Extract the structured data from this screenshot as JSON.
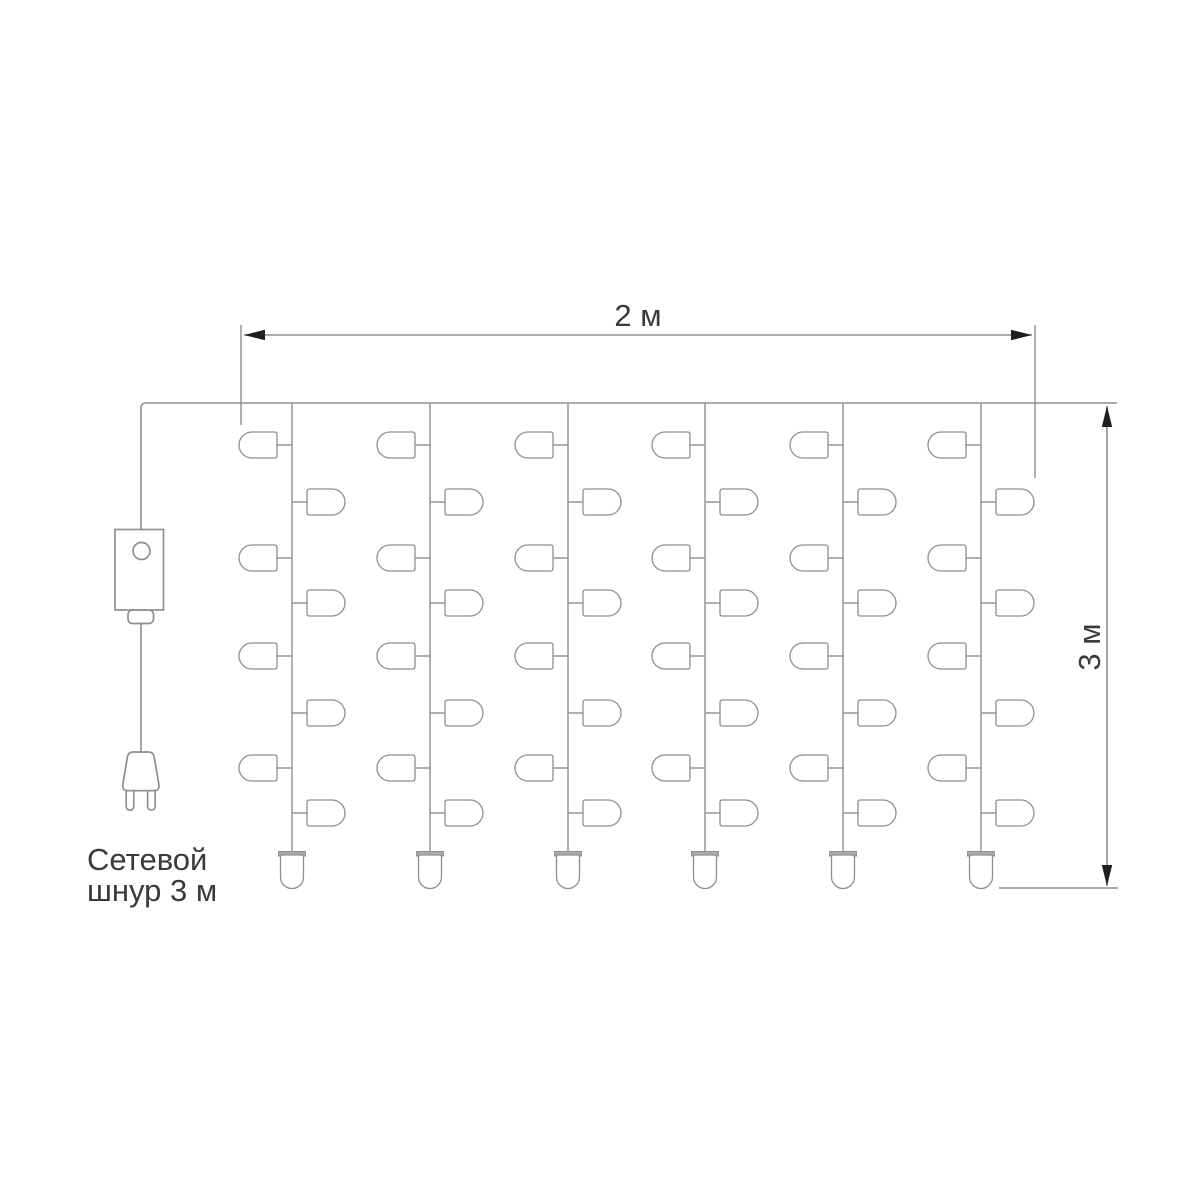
{
  "diagram": {
    "kind": "led-curtain-garland-wiring-diagram",
    "width_dimension": {
      "label": "2 м"
    },
    "height_dimension": {
      "label": "3 м"
    },
    "cord_label": {
      "line1": "Сетевой",
      "line2": "шнур 3 м"
    },
    "colors": {
      "background": "#ffffff",
      "line": "#8f8f8f",
      "arrow": "#1f1f1f",
      "text": "#3a3a3a",
      "bulb_cap": "#ababab"
    },
    "curtain": {
      "strand_count": 6,
      "bulbs_per_strand": 9,
      "side_bulbs_per_strand": 8,
      "end_bulbs_per_strand": 1,
      "geometry": {
        "top_wire_y": 403,
        "top_wire_x1": 141,
        "top_wire_x2": 1117,
        "corner_radius": 5,
        "strand_xs": [
          292,
          430,
          568,
          705,
          843,
          981
        ],
        "bulb_row_ys": [
          445,
          502,
          558,
          603,
          656,
          713,
          768,
          813
        ],
        "first_bulb_side": "left",
        "side_bulb": {
          "lead": 15,
          "length": 38,
          "height": 26,
          "corner": 2.5
        },
        "end_bulb": {
          "cap_y": 851.5,
          "cap_w": 27,
          "cap_h": 4.5,
          "body_top": 855,
          "tip_y": 888.5,
          "half_w": 11.5,
          "corner": 2
        }
      }
    },
    "power": {
      "wire_x": 141,
      "controller": {
        "x": 115,
        "y": 529.5,
        "w": 48.5,
        "h": 80.5,
        "circle_cx": 141.5,
        "circle_cy": 551,
        "circle_r": 8.5
      },
      "connector": {
        "x": 128,
        "y": 610,
        "w": 25.5,
        "h": 13.5,
        "r": 4.5
      },
      "cord": {
        "y1": 623.5,
        "y2": 751.7
      },
      "plug": {
        "top_y": 752,
        "bottom_y": 790.7,
        "prong_tip_y": 810
      }
    },
    "dims": {
      "horizontal": {
        "line_y": 335,
        "x1": 244,
        "x2": 1032,
        "ext_left_x": 241,
        "ext_left_y1": 325,
        "ext_left_y2": 425,
        "ext_right_x": 1035,
        "ext_right_y1": 325,
        "ext_right_y2": 478,
        "label_x": 638,
        "label_y": 326
      },
      "vertical": {
        "line_x": 1107,
        "y1": 406,
        "y2": 886,
        "ext_bottom_y": 888,
        "ext_bottom_x1": 999,
        "ext_bottom_x2": 1118,
        "label_x": 1100,
        "label_y": 647
      }
    }
  }
}
